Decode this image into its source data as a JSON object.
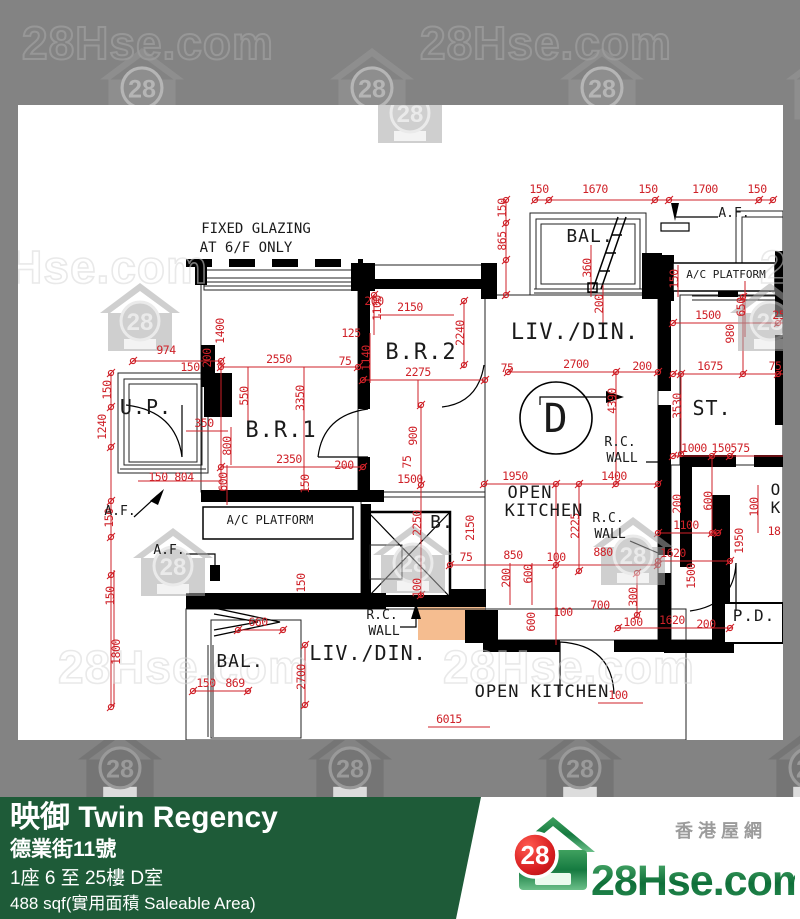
{
  "watermark": {
    "text": "28Hse.com",
    "badge": "28"
  },
  "footer": {
    "title": "映御 Twin Regency",
    "address": "德業街11號",
    "floor_unit": "1座 6 至 25樓 D室",
    "area": "488 sqf(實用面積 Saleable Area)"
  },
  "logo": {
    "site": "28Hse.com",
    "badge": "28",
    "tagline": "香港屋網"
  },
  "colors": {
    "accent_green": "#1e5b38",
    "dim_red": "#cf2128",
    "unit_fill": "#f5bd90",
    "adjacent_fill": "#fbe3cd",
    "logo_green": "#1e7d46",
    "logo_red": "#d81e20"
  },
  "plan": {
    "notes": [
      "FIXED GLAZING",
      "AT 6/F ONLY"
    ],
    "labels": [
      {
        "t": "150",
        "x": 521,
        "y": 88
      },
      {
        "t": "1670",
        "x": 577,
        "y": 88
      },
      {
        "t": "150",
        "x": 630,
        "y": 88
      },
      {
        "t": "1700",
        "x": 687,
        "y": 88
      },
      {
        "t": "150",
        "x": 739,
        "y": 88
      },
      {
        "t": "150",
        "x": 488,
        "y": 103,
        "r": 1
      },
      {
        "t": "865",
        "x": 488,
        "y": 136,
        "r": 1
      },
      {
        "t": "360",
        "x": 573,
        "y": 163,
        "r": 1
      },
      {
        "t": "200",
        "x": 585,
        "y": 199,
        "r": 1
      },
      {
        "t": "150",
        "x": 660,
        "y": 174,
        "r": 1
      },
      {
        "t": "650",
        "x": 727,
        "y": 202,
        "r": 1
      },
      {
        "t": "1500",
        "x": 690,
        "y": 214
      },
      {
        "t": "980",
        "x": 716,
        "y": 229,
        "r": 1
      },
      {
        "t": "250",
        "x": 764,
        "y": 214
      },
      {
        "t": "1675",
        "x": 692,
        "y": 265
      },
      {
        "t": "75",
        "x": 757,
        "y": 265
      },
      {
        "t": "3530",
        "x": 663,
        "y": 301,
        "r": 1
      },
      {
        "t": "1000",
        "x": 676,
        "y": 347
      },
      {
        "t": "150",
        "x": 703,
        "y": 347
      },
      {
        "t": "575",
        "x": 722,
        "y": 347
      },
      {
        "t": "600",
        "x": 694,
        "y": 396,
        "r": 1
      },
      {
        "t": "200",
        "x": 663,
        "y": 399,
        "r": 1
      },
      {
        "t": "1100",
        "x": 668,
        "y": 424
      },
      {
        "t": "1950",
        "x": 725,
        "y": 436,
        "r": 1
      },
      {
        "t": "1620",
        "x": 655,
        "y": 452
      },
      {
        "t": "1500",
        "x": 677,
        "y": 471,
        "r": 1
      },
      {
        "t": "100",
        "x": 740,
        "y": 402,
        "r": 1
      },
      {
        "t": "18",
        "x": 756,
        "y": 430
      },
      {
        "t": "100",
        "x": 615,
        "y": 521
      },
      {
        "t": "1620",
        "x": 654,
        "y": 519
      },
      {
        "t": "200",
        "x": 688,
        "y": 523
      },
      {
        "t": "700",
        "x": 582,
        "y": 504
      },
      {
        "t": "100",
        "x": 545,
        "y": 511
      },
      {
        "t": "600",
        "x": 517,
        "y": 517,
        "r": 1
      },
      {
        "t": "6015",
        "x": 431,
        "y": 618
      },
      {
        "t": "100",
        "x": 600,
        "y": 594
      },
      {
        "t": "660",
        "x": 240,
        "y": 521
      },
      {
        "t": "150",
        "x": 188,
        "y": 582
      },
      {
        "t": "869",
        "x": 217,
        "y": 582
      },
      {
        "t": "2700",
        "x": 287,
        "y": 572,
        "r": 1
      },
      {
        "t": "1800",
        "x": 102,
        "y": 547,
        "r": 1
      },
      {
        "t": "150",
        "x": 96,
        "y": 491,
        "r": 1
      },
      {
        "t": "974",
        "x": 148,
        "y": 249
      },
      {
        "t": "150",
        "x": 172,
        "y": 266
      },
      {
        "t": "150",
        "x": 93,
        "y": 285,
        "r": 1
      },
      {
        "t": "1240",
        "x": 88,
        "y": 322,
        "r": 1
      },
      {
        "t": "150",
        "x": 95,
        "y": 413,
        "r": 1
      },
      {
        "t": "150",
        "x": 140,
        "y": 376
      },
      {
        "t": "804",
        "x": 166,
        "y": 376
      },
      {
        "t": "350",
        "x": 186,
        "y": 322
      },
      {
        "t": "800",
        "x": 213,
        "y": 341,
        "r": 1
      },
      {
        "t": "600",
        "x": 209,
        "y": 377,
        "r": 1
      },
      {
        "t": "550",
        "x": 230,
        "y": 291,
        "r": 1
      },
      {
        "t": "1400",
        "x": 206,
        "y": 226,
        "r": 1
      },
      {
        "t": "200",
        "x": 193,
        "y": 253,
        "r": 1
      },
      {
        "t": "2550",
        "x": 261,
        "y": 258
      },
      {
        "t": "2350",
        "x": 271,
        "y": 358
      },
      {
        "t": "3350",
        "x": 286,
        "y": 293,
        "r": 1
      },
      {
        "t": "150",
        "x": 291,
        "y": 379,
        "r": 1
      },
      {
        "t": "200",
        "x": 326,
        "y": 364
      },
      {
        "t": "1500",
        "x": 392,
        "y": 378
      },
      {
        "t": "900",
        "x": 399,
        "y": 331,
        "r": 1
      },
      {
        "t": "75",
        "x": 393,
        "y": 357,
        "r": 1
      },
      {
        "t": "2250",
        "x": 403,
        "y": 418,
        "r": 1
      },
      {
        "t": "100",
        "x": 403,
        "y": 483,
        "r": 1
      },
      {
        "t": "150",
        "x": 287,
        "y": 478,
        "r": 1
      },
      {
        "t": "200",
        "x": 356,
        "y": 200
      },
      {
        "t": "2150",
        "x": 392,
        "y": 206
      },
      {
        "t": "1100",
        "x": 363,
        "y": 203,
        "r": 1
      },
      {
        "t": "125",
        "x": 333,
        "y": 232
      },
      {
        "t": "1140",
        "x": 352,
        "y": 253,
        "r": 1
      },
      {
        "t": "2275",
        "x": 400,
        "y": 271
      },
      {
        "t": "75",
        "x": 327,
        "y": 260
      },
      {
        "t": "2240",
        "x": 446,
        "y": 228,
        "r": 1
      },
      {
        "t": "2700",
        "x": 558,
        "y": 263
      },
      {
        "t": "75",
        "x": 489,
        "y": 267
      },
      {
        "t": "200",
        "x": 624,
        "y": 265
      },
      {
        "t": "4390",
        "x": 598,
        "y": 296,
        "r": 1
      },
      {
        "t": "1950",
        "x": 497,
        "y": 375
      },
      {
        "t": "1400",
        "x": 596,
        "y": 375
      },
      {
        "t": "2150",
        "x": 456,
        "y": 423,
        "r": 1
      },
      {
        "t": "2225",
        "x": 561,
        "y": 421,
        "r": 1
      },
      {
        "t": "75",
        "x": 448,
        "y": 456
      },
      {
        "t": "850",
        "x": 495,
        "y": 454
      },
      {
        "t": "100",
        "x": 538,
        "y": 456
      },
      {
        "t": "880",
        "x": 585,
        "y": 451
      },
      {
        "t": "200",
        "x": 492,
        "y": 473,
        "r": 1
      },
      {
        "t": "600",
        "x": 514,
        "y": 469,
        "r": 1
      },
      {
        "t": "300",
        "x": 619,
        "y": 492,
        "r": 1
      },
      {
        "t": "FIXED GLAZING",
        "x": 238,
        "y": 128,
        "k": "n",
        "s": 14
      },
      {
        "t": "AT 6/F ONLY",
        "x": 228,
        "y": 147,
        "k": "n",
        "s": 14
      },
      {
        "t": "U.P.",
        "x": 128,
        "y": 309,
        "k": "r",
        "s": 20
      },
      {
        "t": "B.R.1",
        "x": 263,
        "y": 332,
        "k": "r",
        "s": 22
      },
      {
        "t": "B.R.2",
        "x": 403,
        "y": 254,
        "k": "r",
        "s": 22
      },
      {
        "t": "LIV./DIN.",
        "x": 557,
        "y": 234,
        "k": "r",
        "s": 22
      },
      {
        "t": "BAL.",
        "x": 572,
        "y": 137,
        "k": "r",
        "s": 18
      },
      {
        "t": "D",
        "x": 538,
        "y": 327,
        "k": "r",
        "s": 40
      },
      {
        "t": "OPEN",
        "x": 512,
        "y": 393,
        "k": "r",
        "s": 17
      },
      {
        "t": "KITCHEN",
        "x": 526,
        "y": 411,
        "k": "r",
        "s": 17
      },
      {
        "t": "B.",
        "x": 424,
        "y": 423,
        "k": "r",
        "s": 18
      },
      {
        "t": "ST.",
        "x": 694,
        "y": 310,
        "k": "r",
        "s": 20
      },
      {
        "t": "P.D.",
        "x": 736,
        "y": 516,
        "k": "r",
        "s": 16
      },
      {
        "t": "BAL.",
        "x": 222,
        "y": 562,
        "k": "r",
        "s": 18
      },
      {
        "t": "LIV./DIN.",
        "x": 350,
        "y": 555,
        "k": "r",
        "s": 20
      },
      {
        "t": "OPEN KITCHEN",
        "x": 524,
        "y": 592,
        "k": "r",
        "s": 17
      },
      {
        "t": "O",
        "x": 758,
        "y": 390,
        "k": "r",
        "s": 16
      },
      {
        "t": "K",
        "x": 758,
        "y": 408,
        "k": "r",
        "s": 16
      },
      {
        "t": "A.F.",
        "x": 716,
        "y": 112,
        "k": "n"
      },
      {
        "t": "A.F.",
        "x": 102,
        "y": 410,
        "k": "n"
      },
      {
        "t": "A.F.",
        "x": 151,
        "y": 449,
        "k": "n"
      },
      {
        "t": "A/C PLATFORM",
        "x": 708,
        "y": 173,
        "k": "n",
        "s": 11
      },
      {
        "t": "A/C PLATFORM",
        "x": 252,
        "y": 419,
        "k": "n",
        "s": 12
      },
      {
        "t": "R.C.",
        "x": 602,
        "y": 341,
        "k": "n"
      },
      {
        "t": "WALL",
        "x": 604,
        "y": 357,
        "k": "n"
      },
      {
        "t": "R.C.",
        "x": 590,
        "y": 417,
        "k": "n"
      },
      {
        "t": "WALL",
        "x": 592,
        "y": 433,
        "k": "n"
      },
      {
        "t": "R.C.",
        "x": 364,
        "y": 514,
        "k": "n"
      },
      {
        "t": "WALL",
        "x": 366,
        "y": 530,
        "k": "n"
      }
    ]
  }
}
